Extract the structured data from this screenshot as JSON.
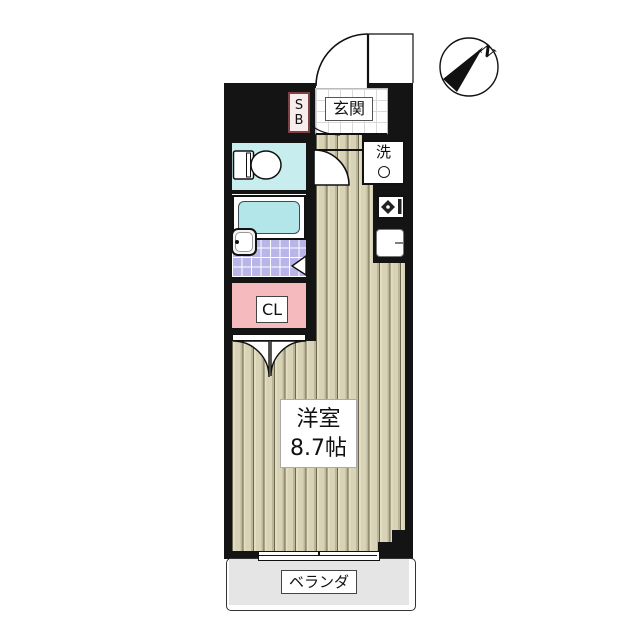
{
  "compass": {
    "north_label": "N"
  },
  "rooms": {
    "entrance": {
      "label": "玄関"
    },
    "shoe_box": {
      "line1": "S",
      "line2": "B"
    },
    "laundry": {
      "label": "洗"
    },
    "closet": {
      "label": "CL"
    },
    "main_room": {
      "name": "洋室",
      "size": "8.7帖"
    },
    "veranda": {
      "label": "ベランダ"
    }
  },
  "colors": {
    "wall": "#141414",
    "flooring_base": "#d8d3b6",
    "toilet_room": "#c7edef",
    "bathtub_water": "#b3e6e9",
    "bath_floor_tile": "#b9b5e8",
    "closet_pink": "#f4babe",
    "shoe_box_border": "#7d4343",
    "veranda_gray": "#e5e5e5",
    "entrance_tile_line": "#d9d9d9"
  }
}
